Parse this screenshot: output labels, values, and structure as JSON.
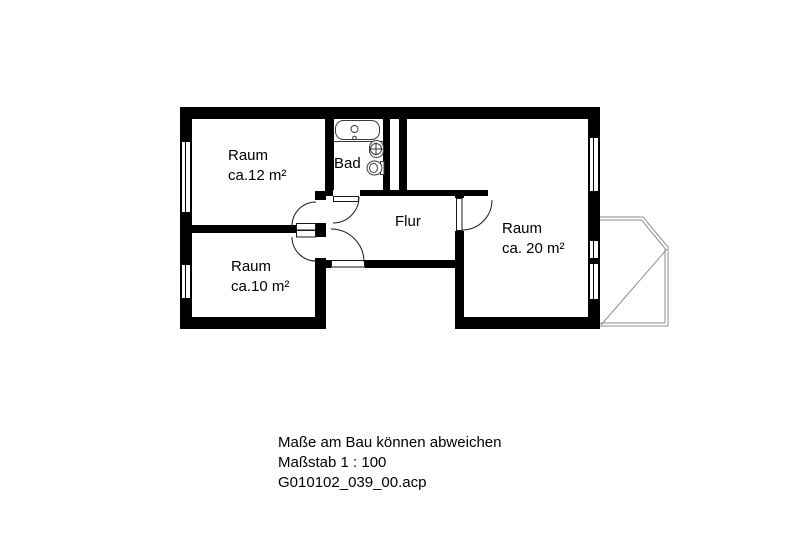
{
  "drawing": {
    "rooms": {
      "raum12": {
        "name": "Raum",
        "area": "ca.12 m²"
      },
      "raum10": {
        "name": "Raum",
        "area": "ca.10 m²"
      },
      "raum20": {
        "name": "Raum",
        "area": "ca. 20 m²"
      },
      "bad": {
        "name": "Bad"
      },
      "flur": {
        "name": "Flur"
      }
    },
    "footer": {
      "disclaimer": "Maße am Bau können abweichen",
      "scale": "Maßstab 1 : 100",
      "filename": "G010102_039_00.acp"
    },
    "colors": {
      "wall": "#000000",
      "door_line": "#1a1a1a",
      "fixture_line": "#3a3a3a",
      "balcony_line": "#8f8f8f",
      "background": "#ffffff"
    }
  }
}
